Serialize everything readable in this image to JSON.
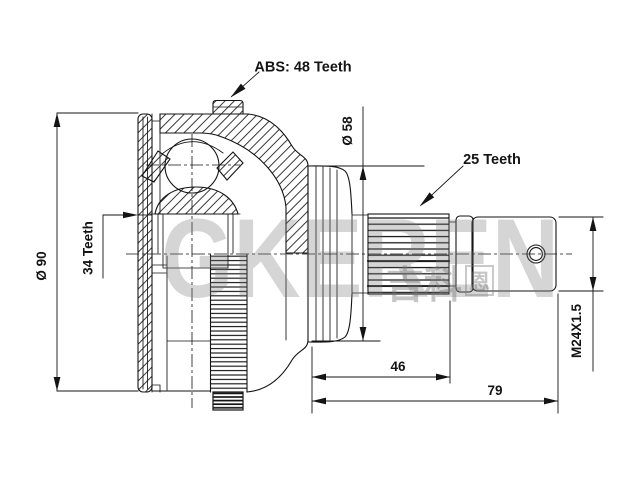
{
  "drawing": {
    "labels": {
      "abs_ring": "ABS: 48 Teeth",
      "stem_diameter": "Ø 58",
      "spline_teeth": "25 Teeth",
      "body_diameter": "Ø 90",
      "inner_spline_teeth": "34 Teeth",
      "thread_spec": "M24X1.5",
      "spline_length": "46",
      "shaft_length": "79"
    },
    "watermark": {
      "brand": "GKEREN",
      "cjk": "吉科",
      "cjk_boxed": "恩"
    },
    "colors": {
      "line": "#141414",
      "background": "#ffffff",
      "watermark": "#777777"
    }
  }
}
